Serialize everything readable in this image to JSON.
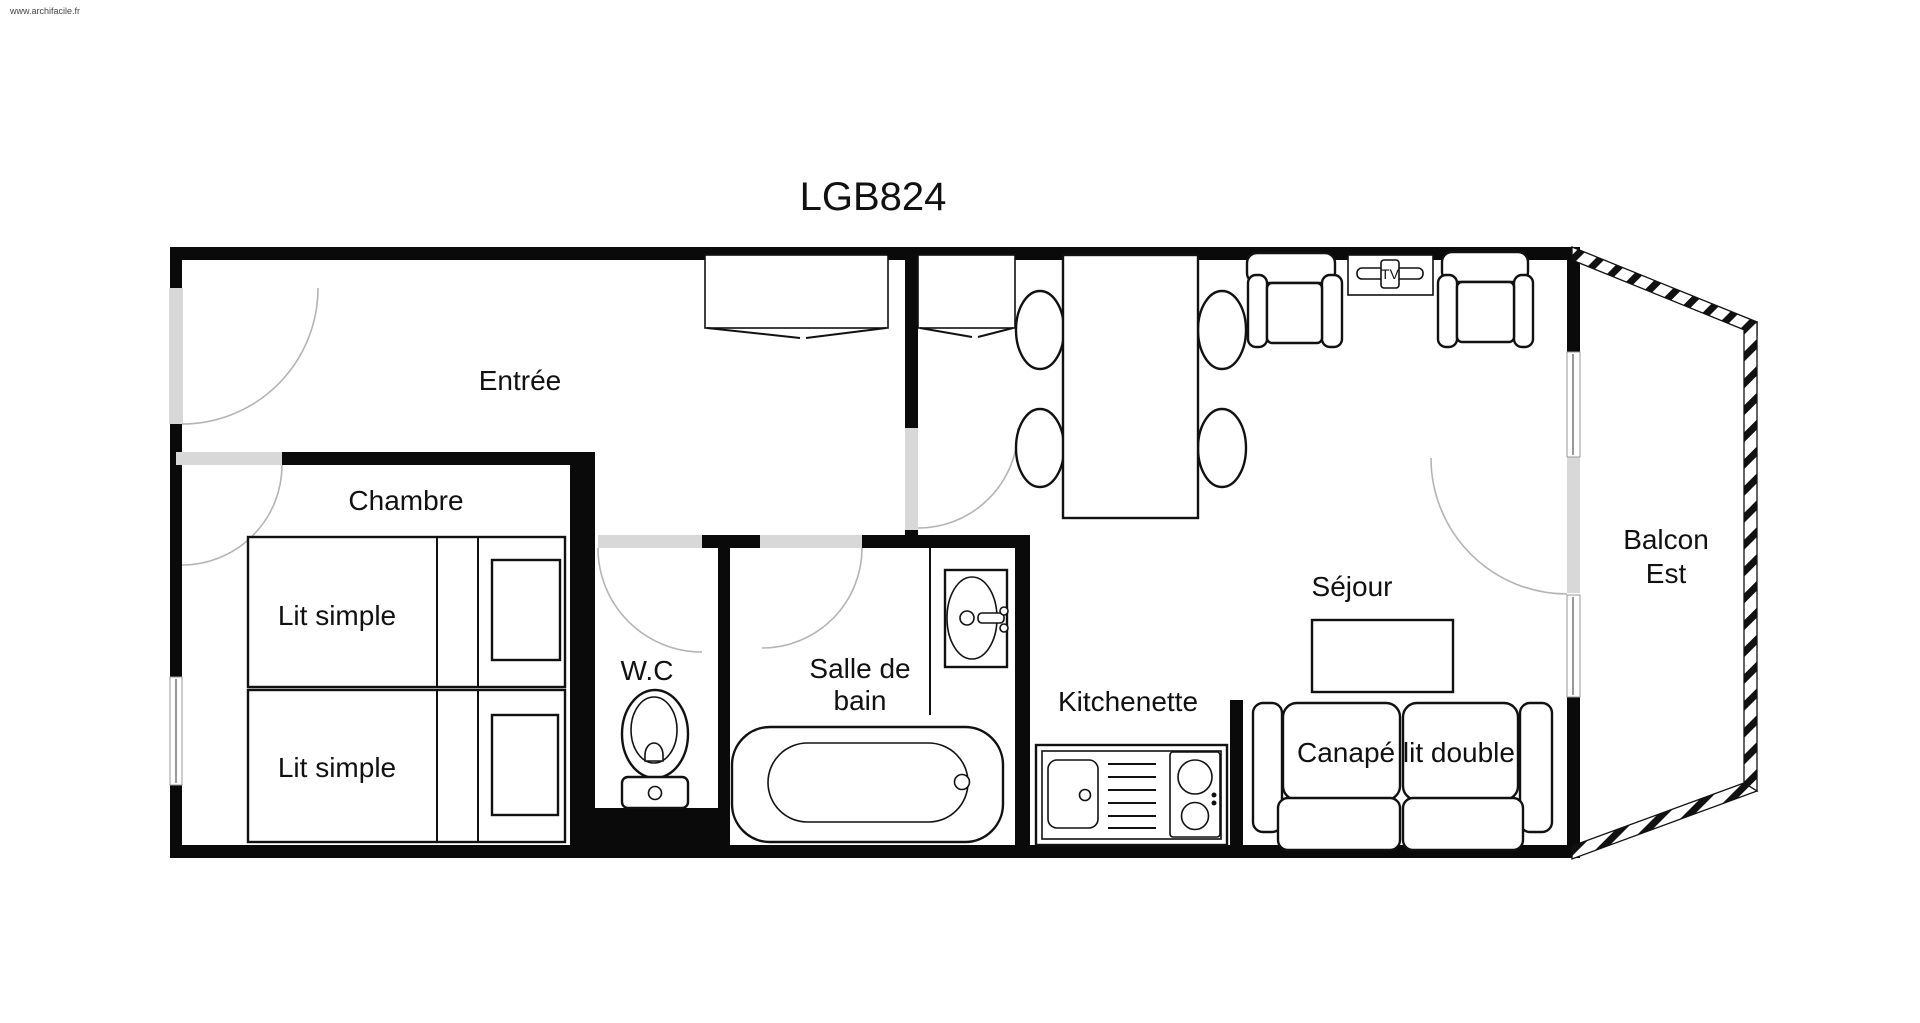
{
  "watermark": "www.archifacile.fr",
  "title": "LGB824",
  "rooms": {
    "entree": "Entrée",
    "chambre": "Chambre",
    "wc": "W.C",
    "salle_de_bain_line1": "Salle de",
    "salle_de_bain_line2": "bain",
    "kitchenette": "Kitchenette",
    "sejour": "Séjour",
    "balcon_line1": "Balcon",
    "balcon_line2": "Est"
  },
  "furniture": {
    "bed1_label": "Lit simple",
    "bed2_label": "Lit simple",
    "sofa_label": "Canapé lit double",
    "tv_label": "TV"
  },
  "colors": {
    "wall": "#0a0a0a",
    "door_opening": "#d8d8d8",
    "arc": "#b4b4b4",
    "text": "#111111",
    "background": "#ffffff"
  }
}
